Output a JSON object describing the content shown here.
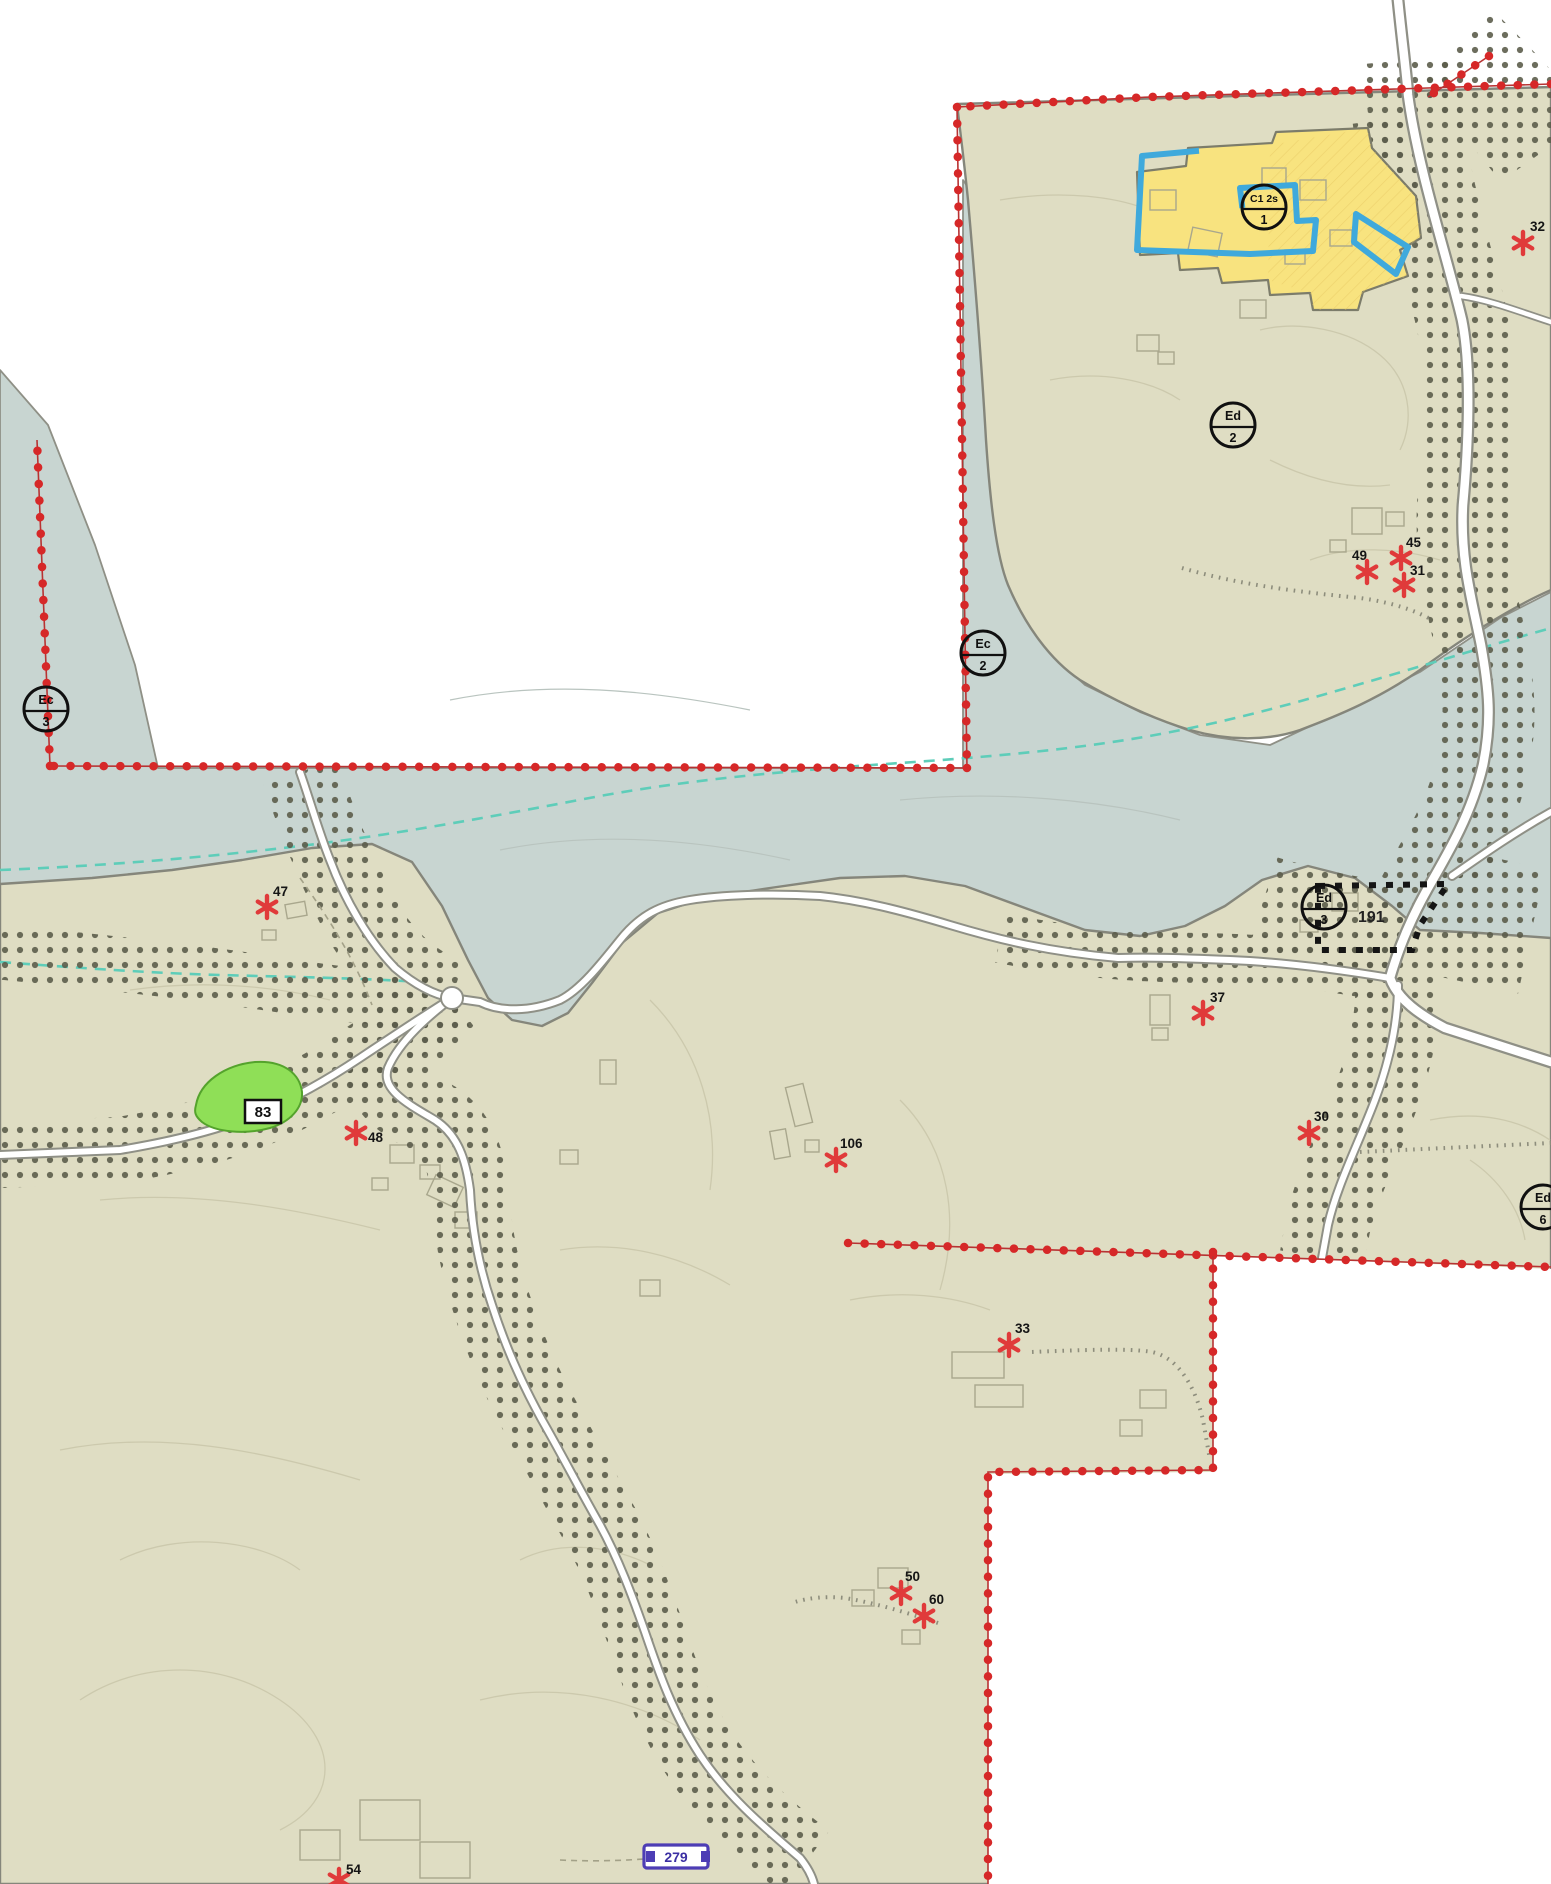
{
  "map": {
    "colors": {
      "background": "#ffffff",
      "terrain": "#dfddc3",
      "water": "#c8d5d1",
      "boundary": "#d62828",
      "road_fill": "#ffffff",
      "road_casing": "#8f9086",
      "stipple": "#5c5d4b",
      "stream": "#5ecdb9",
      "zone_yellow": "#f8e37f",
      "zone_outline_blue": "#3fa9dc",
      "green_area": "#8fdf57",
      "marker_red": "#e03a3a"
    },
    "zone_labels": [
      {
        "code": "C1 2s",
        "number": "1",
        "x": 1264,
        "y": 207
      },
      {
        "code": "Ed",
        "number": "2",
        "x": 1233,
        "y": 425
      },
      {
        "code": "Ec",
        "number": "2",
        "x": 983,
        "y": 653
      },
      {
        "code": "Ec",
        "number": "3",
        "x": 46,
        "y": 709
      },
      {
        "code": "Ed",
        "number": "3",
        "x": 1324,
        "y": 907
      },
      {
        "code": "Ed",
        "number": "6",
        "x": 1543,
        "y": 1207
      }
    ],
    "poi_markers": [
      {
        "label": "32",
        "x": 1523,
        "y": 243,
        "lx": 1530,
        "ly": 231
      },
      {
        "label": "45",
        "x": 1401,
        "y": 558,
        "lx": 1406,
        "ly": 547
      },
      {
        "label": "49",
        "x": 1367,
        "y": 572,
        "lx": 1352,
        "ly": 560
      },
      {
        "label": "31",
        "x": 1404,
        "y": 585,
        "lx": 1410,
        "ly": 575
      },
      {
        "label": "47",
        "x": 267,
        "y": 907,
        "lx": 273,
        "ly": 896
      },
      {
        "label": "37",
        "x": 1203,
        "y": 1013,
        "lx": 1210,
        "ly": 1002
      },
      {
        "label": "30",
        "x": 1309,
        "y": 1133,
        "lx": 1314,
        "ly": 1121
      },
      {
        "label": "48",
        "x": 356,
        "y": 1133,
        "lx": 368,
        "ly": 1142
      },
      {
        "label": "106",
        "x": 836,
        "y": 1160,
        "lx": 840,
        "ly": 1148
      },
      {
        "label": "33",
        "x": 1009,
        "y": 1345,
        "lx": 1015,
        "ly": 1333
      },
      {
        "label": "50",
        "x": 901,
        "y": 1593,
        "lx": 905,
        "ly": 1581
      },
      {
        "label": "60",
        "x": 924,
        "y": 1616,
        "lx": 929,
        "ly": 1604
      },
      {
        "label": "54",
        "x": 339,
        "y": 1880,
        "lx": 346,
        "ly": 1874
      }
    ],
    "area_labels": {
      "green_area_number": "83",
      "parcel_number": "191",
      "road_number": "279"
    }
  }
}
